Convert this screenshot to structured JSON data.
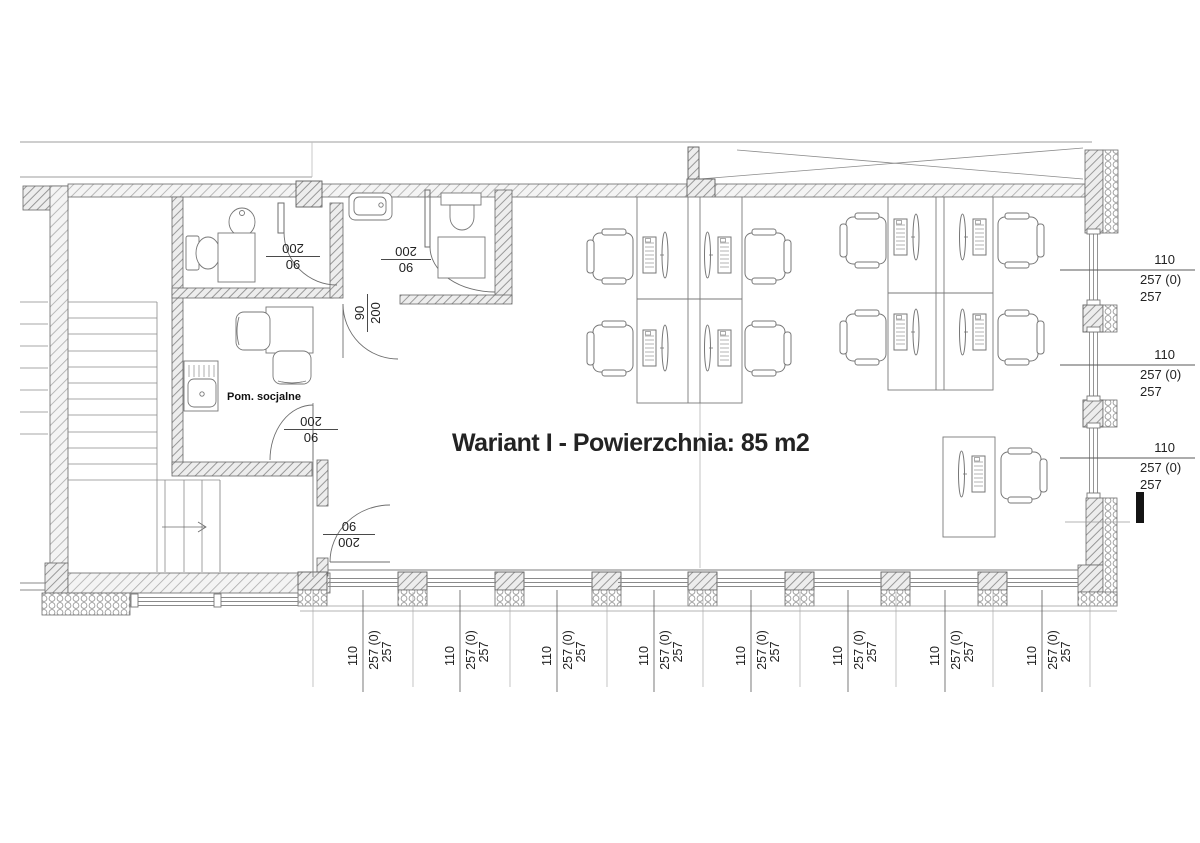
{
  "title": "Wariant I - Powierzchnia: 85 m2",
  "rooms": {
    "social": "Pom. socjalne"
  },
  "doors": {
    "toilet1": {
      "height": "200",
      "width": "90"
    },
    "toilet2": {
      "height": "200",
      "width": "90"
    },
    "toilet2_corridor": {
      "height": "200",
      "width": "90"
    },
    "social_room": {
      "height": "200",
      "width": "90"
    },
    "corridor_exit": {
      "height": "200",
      "width": "90"
    }
  },
  "dims": {
    "right": [
      {
        "v1": "110",
        "v2": "257 (0)",
        "v3": "257"
      },
      {
        "v1": "110",
        "v2": "257 (0)",
        "v3": "257"
      },
      {
        "v1": "110",
        "v2": "257 (0)",
        "v3": "257"
      }
    ],
    "bottom": [
      {
        "v1": "110",
        "v2": "257 (0)",
        "v3": "257"
      },
      {
        "v1": "110",
        "v2": "257 (0)",
        "v3": "257"
      },
      {
        "v1": "110",
        "v2": "257 (0)",
        "v3": "257"
      },
      {
        "v1": "110",
        "v2": "257 (0)",
        "v3": "257"
      },
      {
        "v1": "110",
        "v2": "257 (0)",
        "v3": "257"
      },
      {
        "v1": "110",
        "v2": "257 (0)",
        "v3": "257"
      },
      {
        "v1": "110",
        "v2": "257 (0)",
        "v3": "257"
      },
      {
        "v1": "110",
        "v2": "257 (0)",
        "v3": "257"
      }
    ]
  }
}
